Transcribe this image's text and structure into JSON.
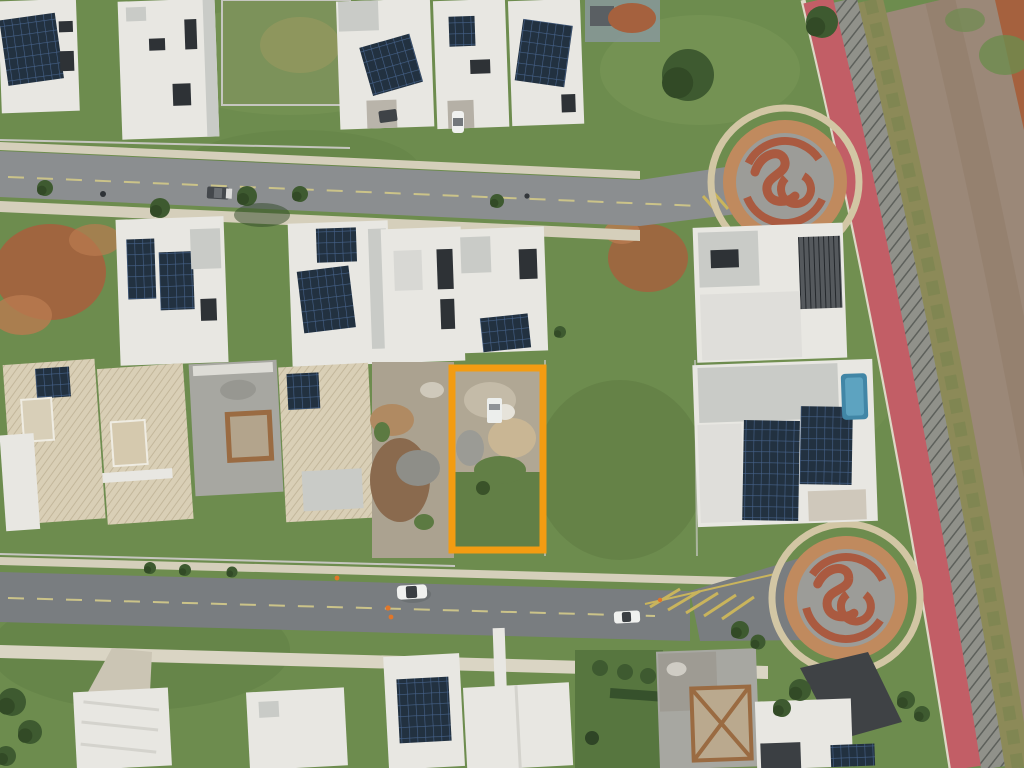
{
  "scene": {
    "type": "aerial-drone-photo",
    "subject": "residential condominium street, aerial top-down view",
    "highlight": {
      "shape": "rectangle",
      "color": "#f39c12",
      "x": 452,
      "y": 368,
      "width": 91,
      "height": 182,
      "meaning": "orange outline marking a lot under construction"
    },
    "features": [
      "houses with rooftop solar panels",
      "two decorative cul-de-sacs with terracotta swirl pattern",
      "red bike lane along perimeter fence",
      "dirt service road on right edge",
      "two asphalt streets with yellow center lines and chevron markings",
      "white cars on lower street, dark vehicle on upper street",
      "vacant green lots and red-dirt patches",
      "houses under construction with exposed concrete and timber"
    ]
  },
  "colors": {
    "grassBase": "#6d8c4e",
    "grassLight": "#86a15f",
    "grassDark": "#55713d",
    "roadTop": "#8b8e90",
    "roadBottom": "#797d80",
    "culAsphalt": "#9c9c98",
    "sidewalk": "#d5cfbb",
    "sidewalk2": "#dad5c4",
    "bikePath": "#c25e66",
    "fenceGray": "#90918a",
    "scrub": "#8c8a58",
    "dirtRoad": "#9b8878",
    "redDirt": "#a5613e",
    "redDirt2": "#b97a50",
    "brickRing": "#c08a5e",
    "terracotta": "#aa5a40",
    "ringWalk": "#d2c6a4",
    "roofWhite": "#e8e7e2",
    "roofGray": "#c9cbc7",
    "roofBeige": "#d9cfb6",
    "solarDark": "#223140",
    "concrete": "#a7a7a1",
    "wood": "#9a6b42",
    "poolBlue": "#4186a6",
    "highlight": "#f39c12",
    "marking": "#cbc389",
    "tree": "#3e5a30",
    "carWhite": "#f0f1ef",
    "carDark": "#44484c",
    "cone": "#e0762a",
    "wallLine": "#c6c6c0",
    "rubble": "#aba290"
  }
}
